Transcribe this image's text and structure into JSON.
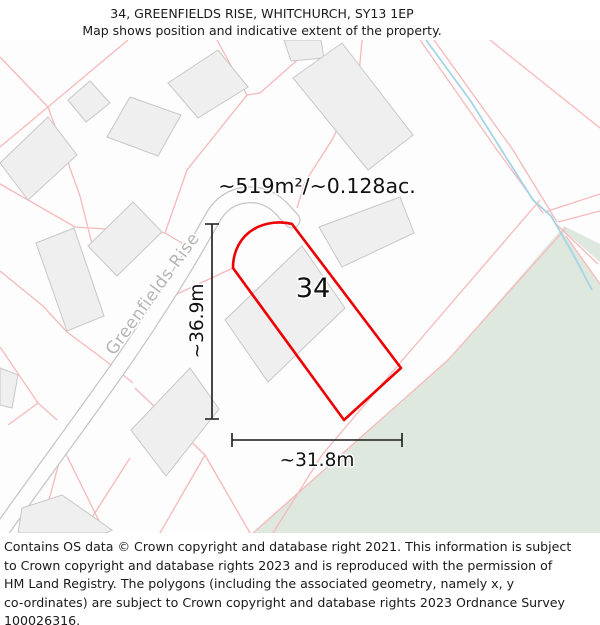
{
  "header": {
    "title": "34, GREENFIELDS RISE, WHITCHURCH, SY13 1EP",
    "subtitle": "Map shows position and indicative extent of the property."
  },
  "map": {
    "area_label": "~519m²/~0.128ac.",
    "plot_number": "34",
    "street_name": "Greenfields Rise",
    "dim_vertical": "~36.9m",
    "dim_horizontal": "~31.8m",
    "colors": {
      "plot_outline": "#ee0000",
      "parcel_line": "#f6b9b9",
      "building_fill": "#f0efef",
      "building_stroke": "#c7c7c7",
      "road_edge": "#c6c6c6",
      "road_fill": "#fdfdfd",
      "green_area": "#dfe8df",
      "stream": "#a5d5e5",
      "dimension": "#1a1a1a",
      "street_text": "#b5b5b5"
    }
  },
  "footer": {
    "lines": [
      "Contains OS data © Crown copyright and database right 2021. This information is subject",
      "to Crown copyright and database rights 2023 and is reproduced with the permission of",
      "HM Land Registry. The polygons (including the associated geometry, namely x, y",
      "co-ordinates) are subject to Crown copyright and database rights 2023 Ordnance Survey",
      "100026316."
    ]
  }
}
